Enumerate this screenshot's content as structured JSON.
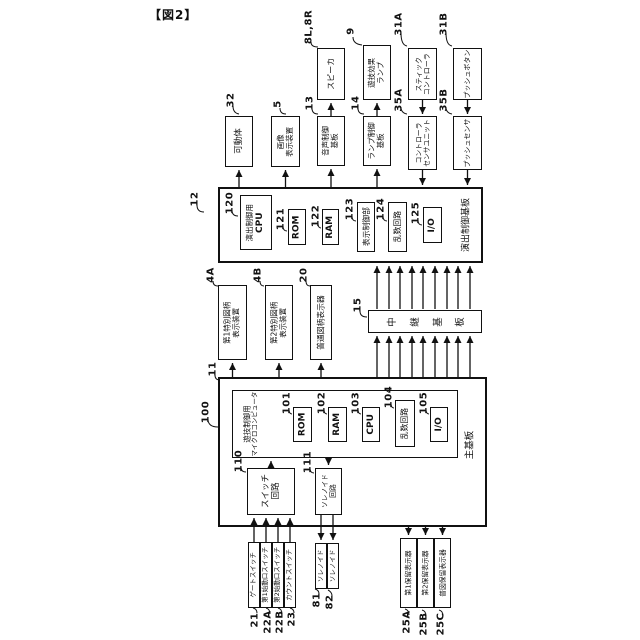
{
  "figure": {
    "title": "【図2】"
  },
  "colors": {
    "ink": "#111111",
    "background": "#ffffff"
  },
  "nodes": {
    "movable": {
      "ref": "32",
      "label": "可動体"
    },
    "image_display": {
      "ref": "5",
      "line1": "画像",
      "line2": "表示装置"
    },
    "speaker": {
      "ref": "8L,8R",
      "label": "スピーカ"
    },
    "audio_board": {
      "ref": "13",
      "line1": "音声制御",
      "line2": "基板"
    },
    "effect_lamp": {
      "ref": "9",
      "line1": "遊技効果",
      "line2": "ランプ"
    },
    "lamp_board": {
      "ref": "14",
      "line1": "ランプ制御",
      "line2": "基板"
    },
    "stick_controller": {
      "ref": "31A",
      "line1": "スティック",
      "line2": "コントローラ"
    },
    "controller_sensor_unit": {
      "ref": "35A",
      "line1": "コントローラ",
      "line2": "センサユニット"
    },
    "push_button": {
      "ref": "31B",
      "label": "プッシュボタン"
    },
    "push_sensor": {
      "ref": "35B",
      "label": "プッシュセンサ"
    },
    "effect_board": {
      "ref": "12",
      "label": "演出制御基板"
    },
    "effect_cpu": {
      "ref": "120",
      "line1": "演出制御用",
      "line2": "CPU"
    },
    "effect_rom": {
      "ref": "121",
      "label": "ROM"
    },
    "effect_ram": {
      "ref": "122",
      "label": "RAM"
    },
    "display_ctrl": {
      "ref": "123",
      "label": "表示制御部"
    },
    "effect_rand": {
      "ref": "124",
      "label": "乱数回路"
    },
    "effect_io": {
      "ref": "125",
      "label": "I/O"
    },
    "sp1_display": {
      "ref": "4A",
      "line1": "第1特別図柄",
      "line2": "表示装置"
    },
    "sp2_display": {
      "ref": "4B",
      "line1": "第2特別図柄",
      "line2": "表示装置"
    },
    "normal_display": {
      "ref": "20",
      "label": "普通図柄表示器"
    },
    "relay_board": {
      "ref": "15",
      "label": "中継基板"
    },
    "main_board": {
      "ref": "11",
      "label": "主基板"
    },
    "game_micro": {
      "ref": "100",
      "line1": "遊技制御用",
      "line2": "マイクロコンピュータ"
    },
    "main_rom": {
      "ref": "101",
      "label": "ROM"
    },
    "main_ram": {
      "ref": "102",
      "label": "RAM"
    },
    "main_cpu": {
      "ref": "103",
      "label": "CPU"
    },
    "main_rand": {
      "ref": "104",
      "label": "乱数回路"
    },
    "main_io": {
      "ref": "105",
      "label": "I/O"
    },
    "switch_circuit": {
      "ref": "110",
      "line1": "スイッチ",
      "line2": "回路"
    },
    "solenoid_circuit": {
      "ref": "111",
      "line1": "ソレノイド",
      "line2": "回路"
    },
    "gate_switch": {
      "ref": "21",
      "label": "ゲートスイッチ"
    },
    "start1_switch": {
      "ref": "22A",
      "label": "第1始動口スイッチ"
    },
    "start2_switch": {
      "ref": "22B",
      "label": "第2始動口スイッチ"
    },
    "count_switch": {
      "ref": "23",
      "label": "カウントスイッチ"
    },
    "solenoid_81": {
      "ref": "81",
      "label": "ソレノイド"
    },
    "solenoid_82": {
      "ref": "82",
      "label": "ソレノイド"
    },
    "hold1_display": {
      "ref": "25A",
      "label": "第1保留表示器"
    },
    "hold2_display": {
      "ref": "25B",
      "label": "第2保留表示器"
    },
    "normal_hold_display": {
      "ref": "25C",
      "label": "普図保留表示器"
    }
  }
}
